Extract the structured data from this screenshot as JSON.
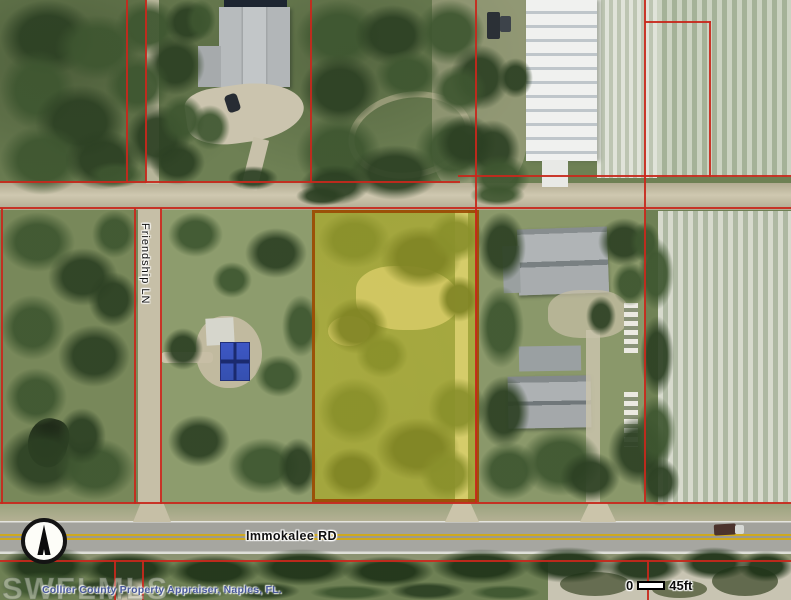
{
  "map": {
    "type": "aerial-parcel-map",
    "road_labels": {
      "vertical": "Friendship LN",
      "horizontal": "Immokalee RD"
    },
    "attribution": "Collier County Property Appraiser, Naples, FL.",
    "watermark": "SWFLMLS",
    "scale_bar": {
      "start": "0",
      "label": "45ft"
    },
    "compass": {
      "icon": "north-arrow"
    },
    "colors": {
      "parcel_line": "#c8281c",
      "highlight_fill": "#dbcf26",
      "highlight_border": "#9a4802",
      "attribution_text": "#4a5a9c",
      "road_asphalt": "#a2a29c",
      "road_centerline": "#cfa91e"
    }
  }
}
